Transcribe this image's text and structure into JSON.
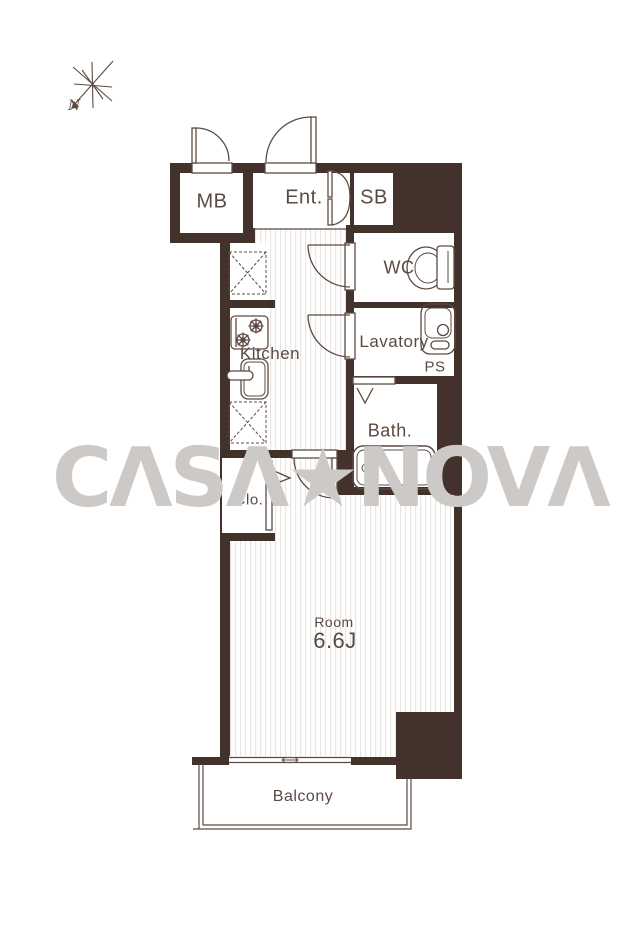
{
  "meta": {
    "type": "apartment-floor-plan"
  },
  "colors": {
    "wall": "#43312b",
    "line": "#5c4a42",
    "text": "#5a4a42",
    "stripe": "#e8e5e3",
    "watermark": "#ccc9c7"
  },
  "compass": {
    "label": "N"
  },
  "rooms": {
    "mb": {
      "label": "MB"
    },
    "entrance": {
      "label": "Ent."
    },
    "shoe_box": {
      "label": "SB"
    },
    "wc": {
      "label": "WC"
    },
    "lavatory": {
      "label": "Lavatory"
    },
    "pipe_space": {
      "label": "PS"
    },
    "kitchen": {
      "label": "Kitchen"
    },
    "bath": {
      "label": "Bath."
    },
    "closet": {
      "label": "Clo."
    },
    "main_room": {
      "label": "Room",
      "size": "6.6J"
    },
    "balcony": {
      "label": "Balcony"
    }
  },
  "watermark": {
    "text": "CASA★NOVA",
    "display": "CΛSΛ★NOVΛ"
  }
}
